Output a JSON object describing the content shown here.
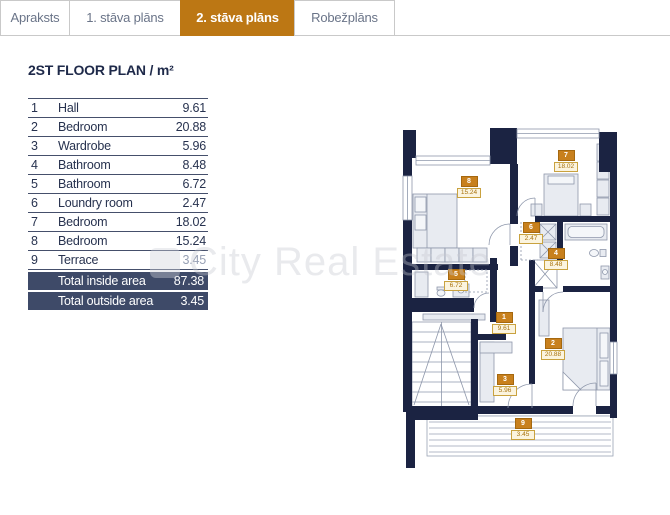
{
  "tabs": [
    {
      "label": "Apraksts",
      "active": false
    },
    {
      "label": "1. stāva plāns",
      "active": false
    },
    {
      "label": "2. stāva plāns",
      "active": true
    },
    {
      "label": "Robežplāns",
      "active": false
    }
  ],
  "page": {
    "title": "2ST FLOOR PLAN / m²"
  },
  "watermark": {
    "text": "City Real Estate"
  },
  "table": {
    "rows": [
      {
        "no": "1",
        "label": "Hall",
        "value": "9.61"
      },
      {
        "no": "2",
        "label": "Bedroom",
        "value": "20.88"
      },
      {
        "no": "3",
        "label": "Wardrobe",
        "value": "5.96"
      },
      {
        "no": "4",
        "label": "Bathroom",
        "value": "8.48"
      },
      {
        "no": "5",
        "label": "Bathroom",
        "value": "6.72"
      },
      {
        "no": "6",
        "label": "Loundry room",
        "value": "2.47"
      },
      {
        "no": "7",
        "label": "Bedroom",
        "value": "18.02"
      },
      {
        "no": "8",
        "label": "Bedroom",
        "value": "15.24"
      },
      {
        "no": "9",
        "label": "Terrace",
        "value": "3.45"
      }
    ],
    "totals": [
      {
        "label": "Total inside area",
        "value": "87.38"
      },
      {
        "label": "Total outside area",
        "value": "3.45"
      }
    ]
  },
  "plan": {
    "rooms": [
      {
        "no": "1",
        "area": "9.61"
      },
      {
        "no": "2",
        "area": "20.88"
      },
      {
        "no": "3",
        "area": "5.96"
      },
      {
        "no": "4",
        "area": "8.48"
      },
      {
        "no": "5",
        "area": "6.72"
      },
      {
        "no": "6",
        "area": "2.47"
      },
      {
        "no": "7",
        "area": "18.02"
      },
      {
        "no": "8",
        "area": "15.24"
      },
      {
        "no": "9",
        "area": "3.45"
      }
    ]
  },
  "colors": {
    "active_tab": "#bc7714",
    "wall": "#1b2342",
    "badge": "#c8801d",
    "total_row_bg": "#3e4a68"
  }
}
